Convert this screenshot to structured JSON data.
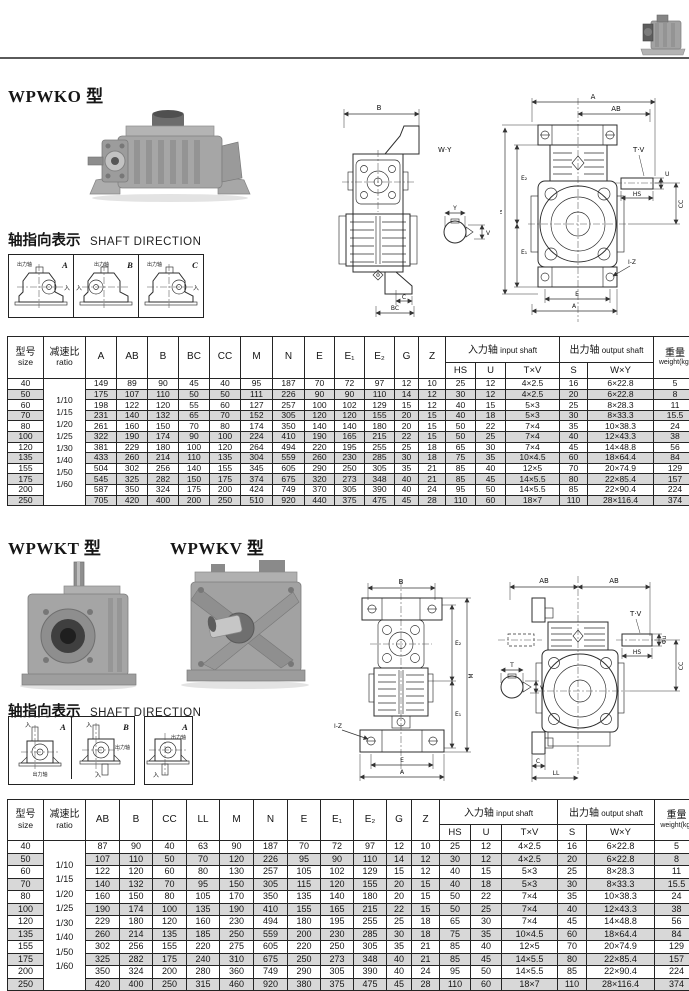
{
  "wpwko": {
    "title": "WPWKO 型",
    "shaft_dir_cn": "轴指向表示",
    "shaft_dir_en": "SHAFT DIRECTION",
    "dir_cells": [
      {
        "letter": "A",
        "out_label": "出力轴",
        "in_label": "入"
      },
      {
        "letter": "B",
        "out_label": "出力轴",
        "in_label": "入"
      },
      {
        "letter": "C",
        "out_label": "出力轴",
        "in_label": "入"
      }
    ]
  },
  "wpwkt": {
    "title": "WPWKT 型",
    "title2": "WPWKV 型",
    "shaft_dir_cn": "轴指向表示",
    "shaft_dir_en": "SHAFT DIRECTION",
    "dir_cells": [
      {
        "letter": "A",
        "out_label": "出力轴",
        "in_label": "入"
      },
      {
        "letter": "B",
        "out_label": "出力轴",
        "in_label": "入"
      },
      {
        "letter": "A",
        "out_label": "出力轴",
        "in_label": "入"
      }
    ]
  },
  "drawings": {
    "d1": {
      "labels": {
        "b": "B",
        "wy": "W·Y",
        "y": "Y",
        "v": "V",
        "c": "C",
        "bc": "BC"
      }
    },
    "d2": {
      "labels": {
        "a": "A",
        "ab": "AB",
        "tv": "T·V",
        "u": "U",
        "hs": "HS",
        "cc": "CC",
        "n": "N",
        "e2": "E₂",
        "e1": "E₁",
        "iz": "I-Z",
        "e": "E",
        "a2": "A"
      }
    },
    "d3": {
      "labels": {
        "b": "B",
        "e2": "E₂",
        "e1": "E₁",
        "m": "M",
        "iz": "I-Z",
        "e": "E",
        "a": "A",
        "t": "T",
        "v": "V"
      }
    },
    "d4": {
      "labels": {
        "ab1": "AB",
        "ab2": "AB",
        "tv": "T·V",
        "u": "Φu",
        "hs": "HS",
        "cc": "CC",
        "c": "C",
        "ll": "LL",
        "t": "T",
        "v": "V"
      }
    }
  },
  "table1": {
    "size_cn": "型号",
    "size_en": "size",
    "ratio_cn": "减速比",
    "ratio_en": "ratio",
    "dim_headers": [
      "A",
      "AB",
      "B",
      "BC",
      "CC",
      "M",
      "N",
      "E",
      "E₁",
      "E₂",
      "G",
      "Z"
    ],
    "input_cn": "入力轴",
    "input_en": "input shaft",
    "output_cn": "出力轴",
    "output_en": "output shaft",
    "weight_cn": "重量",
    "weight_en": "weight(kg)",
    "input_cols": [
      "HS",
      "U",
      "T×V"
    ],
    "output_cols": [
      "S",
      "W×Y"
    ],
    "ratios": [
      "1/10",
      "1/15",
      "1/20",
      "1/25",
      "1/30",
      "1/40",
      "1/50",
      "1/60"
    ],
    "rows": [
      {
        "size": "40",
        "dims": [
          "149",
          "89",
          "90",
          "45",
          "40",
          "95",
          "187",
          "70",
          "72",
          "97",
          "12",
          "10"
        ],
        "input": [
          "25",
          "12",
          "4×2.5"
        ],
        "output": [
          "16",
          "6×22.8"
        ],
        "weight": "5"
      },
      {
        "size": "50",
        "dims": [
          "175",
          "107",
          "110",
          "50",
          "50",
          "111",
          "226",
          "90",
          "90",
          "110",
          "14",
          "12"
        ],
        "input": [
          "30",
          "12",
          "4×2.5"
        ],
        "output": [
          "20",
          "6×22.8"
        ],
        "weight": "8"
      },
      {
        "size": "60",
        "dims": [
          "198",
          "122",
          "120",
          "55",
          "60",
          "127",
          "257",
          "100",
          "102",
          "129",
          "15",
          "12"
        ],
        "input": [
          "40",
          "15",
          "5×3"
        ],
        "output": [
          "25",
          "8×28.3"
        ],
        "weight": "11"
      },
      {
        "size": "70",
        "dims": [
          "231",
          "140",
          "132",
          "65",
          "70",
          "152",
          "305",
          "120",
          "120",
          "155",
          "20",
          "15"
        ],
        "input": [
          "40",
          "18",
          "5×3"
        ],
        "output": [
          "30",
          "8×33.3"
        ],
        "weight": "15.5"
      },
      {
        "size": "80",
        "dims": [
          "261",
          "160",
          "150",
          "70",
          "80",
          "174",
          "350",
          "140",
          "140",
          "180",
          "20",
          "15"
        ],
        "input": [
          "50",
          "22",
          "7×4"
        ],
        "output": [
          "35",
          "10×38.3"
        ],
        "weight": "24"
      },
      {
        "size": "100",
        "dims": [
          "322",
          "190",
          "174",
          "90",
          "100",
          "224",
          "410",
          "190",
          "165",
          "215",
          "22",
          "15"
        ],
        "input": [
          "50",
          "25",
          "7×4"
        ],
        "output": [
          "40",
          "12×43.3"
        ],
        "weight": "38"
      },
      {
        "size": "120",
        "dims": [
          "381",
          "229",
          "180",
          "100",
          "120",
          "264",
          "494",
          "220",
          "195",
          "255",
          "25",
          "18"
        ],
        "input": [
          "65",
          "30",
          "7×4"
        ],
        "output": [
          "45",
          "14×48.8"
        ],
        "weight": "56"
      },
      {
        "size": "135",
        "dims": [
          "433",
          "260",
          "214",
          "110",
          "135",
          "304",
          "559",
          "260",
          "230",
          "285",
          "30",
          "18"
        ],
        "input": [
          "75",
          "35",
          "10×4.5"
        ],
        "output": [
          "60",
          "18×64.4"
        ],
        "weight": "84"
      },
      {
        "size": "155",
        "dims": [
          "504",
          "302",
          "256",
          "140",
          "155",
          "345",
          "605",
          "290",
          "250",
          "305",
          "35",
          "21"
        ],
        "input": [
          "85",
          "40",
          "12×5"
        ],
        "output": [
          "70",
          "20×74.9"
        ],
        "weight": "129"
      },
      {
        "size": "175",
        "dims": [
          "545",
          "325",
          "282",
          "150",
          "175",
          "374",
          "675",
          "320",
          "273",
          "348",
          "40",
          "21"
        ],
        "input": [
          "85",
          "45",
          "14×5.5"
        ],
        "output": [
          "80",
          "22×85.4"
        ],
        "weight": "157"
      },
      {
        "size": "200",
        "dims": [
          "587",
          "350",
          "324",
          "175",
          "200",
          "424",
          "749",
          "370",
          "305",
          "390",
          "40",
          "24"
        ],
        "input": [
          "95",
          "50",
          "14×5.5"
        ],
        "output": [
          "85",
          "22×90.4"
        ],
        "weight": "224"
      },
      {
        "size": "250",
        "dims": [
          "705",
          "420",
          "400",
          "200",
          "250",
          "510",
          "920",
          "440",
          "375",
          "475",
          "45",
          "28"
        ],
        "input": [
          "110",
          "60",
          "18×7"
        ],
        "output": [
          "110",
          "28×116.4"
        ],
        "weight": "374"
      }
    ]
  },
  "table2": {
    "size_cn": "型号",
    "size_en": "size",
    "ratio_cn": "减速比",
    "ratio_en": "ratio",
    "dim_headers": [
      "AB",
      "B",
      "CC",
      "LL",
      "M",
      "N",
      "E",
      "E₁",
      "E₂",
      "G",
      "Z"
    ],
    "input_cn": "入力轴",
    "input_en": "input shaft",
    "output_cn": "出力轴",
    "output_en": "output shaft",
    "weight_cn": "重量",
    "weight_en": "weight(kg)",
    "input_cols": [
      "HS",
      "U",
      "T×V"
    ],
    "output_cols": [
      "S",
      "W×Y"
    ],
    "ratios": [
      "1/10",
      "1/15",
      "1/20",
      "1/25",
      "1/30",
      "1/40",
      "1/50",
      "1/60"
    ],
    "rows": [
      {
        "size": "40",
        "dims": [
          "87",
          "90",
          "40",
          "63",
          "90",
          "187",
          "70",
          "72",
          "97",
          "12",
          "10"
        ],
        "input": [
          "25",
          "12",
          "4×2.5"
        ],
        "output": [
          "16",
          "6×22.8"
        ],
        "weight": "5"
      },
      {
        "size": "50",
        "dims": [
          "107",
          "110",
          "50",
          "70",
          "120",
          "226",
          "95",
          "90",
          "110",
          "14",
          "12"
        ],
        "input": [
          "30",
          "12",
          "4×2.5"
        ],
        "output": [
          "20",
          "6×22.8"
        ],
        "weight": "8"
      },
      {
        "size": "60",
        "dims": [
          "122",
          "120",
          "60",
          "80",
          "130",
          "257",
          "105",
          "102",
          "129",
          "15",
          "12"
        ],
        "input": [
          "40",
          "15",
          "5×3"
        ],
        "output": [
          "25",
          "8×28.3"
        ],
        "weight": "11"
      },
      {
        "size": "70",
        "dims": [
          "140",
          "132",
          "70",
          "95",
          "150",
          "305",
          "115",
          "120",
          "155",
          "20",
          "15"
        ],
        "input": [
          "40",
          "18",
          "5×3"
        ],
        "output": [
          "30",
          "8×33.3"
        ],
        "weight": "15.5"
      },
      {
        "size": "80",
        "dims": [
          "160",
          "150",
          "80",
          "105",
          "170",
          "350",
          "135",
          "140",
          "180",
          "20",
          "15"
        ],
        "input": [
          "50",
          "22",
          "7×4"
        ],
        "output": [
          "35",
          "10×38.3"
        ],
        "weight": "24"
      },
      {
        "size": "100",
        "dims": [
          "190",
          "174",
          "100",
          "135",
          "190",
          "410",
          "155",
          "165",
          "215",
          "22",
          "15"
        ],
        "input": [
          "50",
          "25",
          "7×4"
        ],
        "output": [
          "40",
          "12×43.3"
        ],
        "weight": "38"
      },
      {
        "size": "120",
        "dims": [
          "229",
          "180",
          "120",
          "160",
          "230",
          "494",
          "180",
          "195",
          "255",
          "25",
          "18"
        ],
        "input": [
          "65",
          "30",
          "7×4"
        ],
        "output": [
          "45",
          "14×48.8"
        ],
        "weight": "56"
      },
      {
        "size": "135",
        "dims": [
          "260",
          "214",
          "135",
          "185",
          "250",
          "559",
          "200",
          "230",
          "285",
          "30",
          "18"
        ],
        "input": [
          "75",
          "35",
          "10×4.5"
        ],
        "output": [
          "60",
          "18×64.4"
        ],
        "weight": "84"
      },
      {
        "size": "155",
        "dims": [
          "302",
          "256",
          "155",
          "220",
          "275",
          "605",
          "220",
          "250",
          "305",
          "35",
          "21"
        ],
        "input": [
          "85",
          "40",
          "12×5"
        ],
        "output": [
          "70",
          "20×74.9"
        ],
        "weight": "129"
      },
      {
        "size": "175",
        "dims": [
          "325",
          "282",
          "175",
          "240",
          "310",
          "675",
          "250",
          "273",
          "348",
          "40",
          "21"
        ],
        "input": [
          "85",
          "45",
          "14×5.5"
        ],
        "output": [
          "80",
          "22×85.4"
        ],
        "weight": "157"
      },
      {
        "size": "200",
        "dims": [
          "350",
          "324",
          "200",
          "280",
          "360",
          "749",
          "290",
          "305",
          "390",
          "40",
          "24"
        ],
        "input": [
          "95",
          "50",
          "14×5.5"
        ],
        "output": [
          "85",
          "22×90.4"
        ],
        "weight": "224"
      },
      {
        "size": "250",
        "dims": [
          "420",
          "400",
          "250",
          "315",
          "460",
          "920",
          "380",
          "375",
          "475",
          "45",
          "28"
        ],
        "input": [
          "110",
          "60",
          "18×7"
        ],
        "output": [
          "110",
          "28×116.4"
        ],
        "weight": "374"
      }
    ]
  }
}
